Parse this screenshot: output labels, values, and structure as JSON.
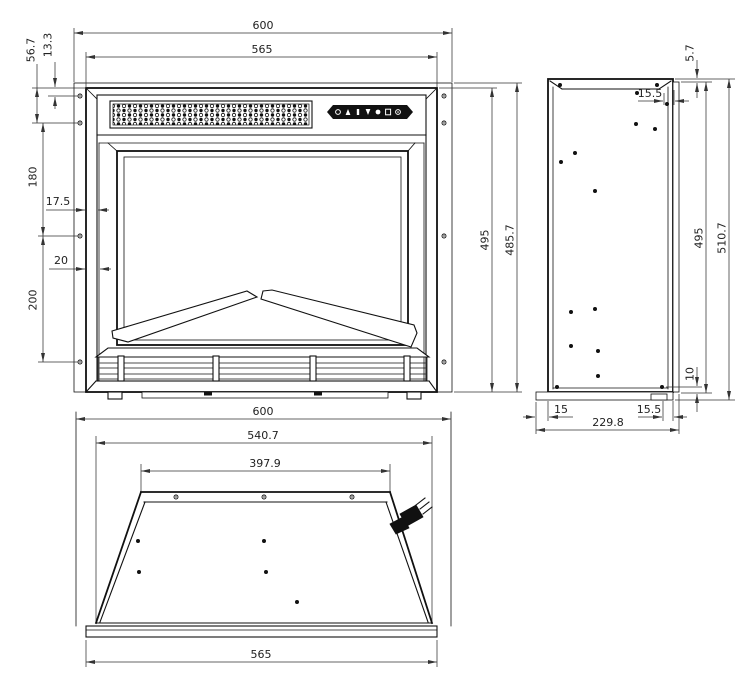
{
  "front": {
    "dims": {
      "overall_width": "600",
      "face_width": "565",
      "offset_13_3": "13.3",
      "offset_56_7": "56.7",
      "spacing_180": "180",
      "lip_17_5": "17.5",
      "lip_20": "20",
      "spacing_200": "200",
      "height_495": "495",
      "height_485_7": "485.7"
    },
    "control_panel_icons": [
      "power-icon",
      "flame-up-icon",
      "dimmer-bar-icon",
      "flame-down-icon",
      "led-icon",
      "timer-icon",
      "heat-icon"
    ]
  },
  "side": {
    "dims": {
      "offset_5_7": "5.7",
      "inset_top_15_5": "15.5",
      "height_495": "495",
      "height_510_7": "510.7",
      "offset_10": "10",
      "flange_15": "15",
      "inset_bottom_15_5": "15.5",
      "depth_229_8": "229.8"
    }
  },
  "bottom": {
    "dims": {
      "overall_width": "600",
      "body_width": "540.7",
      "back_width": "397.9",
      "front_width": "565"
    }
  }
}
